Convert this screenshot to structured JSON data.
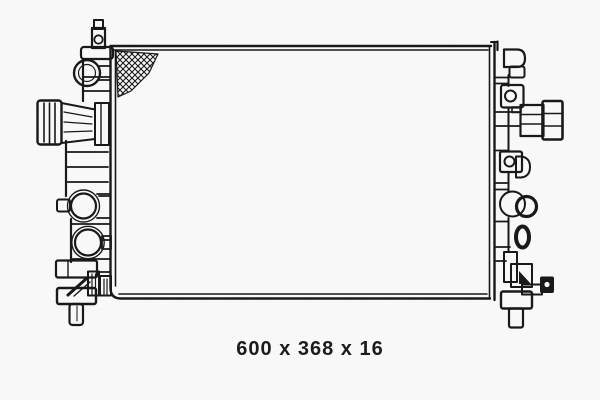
{
  "page": {
    "background": "#ffffff"
  },
  "diagram": {
    "subject": "radiator-technical-line-drawing",
    "line_color": "#1a1a1a",
    "description": "Outline drawing of an automotive radiator: core with crosshatched corner shading, ribbed side tanks, hose connectors left and right, round ports, mounting lugs and bottom drain plugs"
  },
  "caption": {
    "text": "600 x 368 x 16",
    "color": "#1c1c1c"
  },
  "dimensions": {
    "width": "600",
    "height": "368",
    "thickness": "16"
  }
}
